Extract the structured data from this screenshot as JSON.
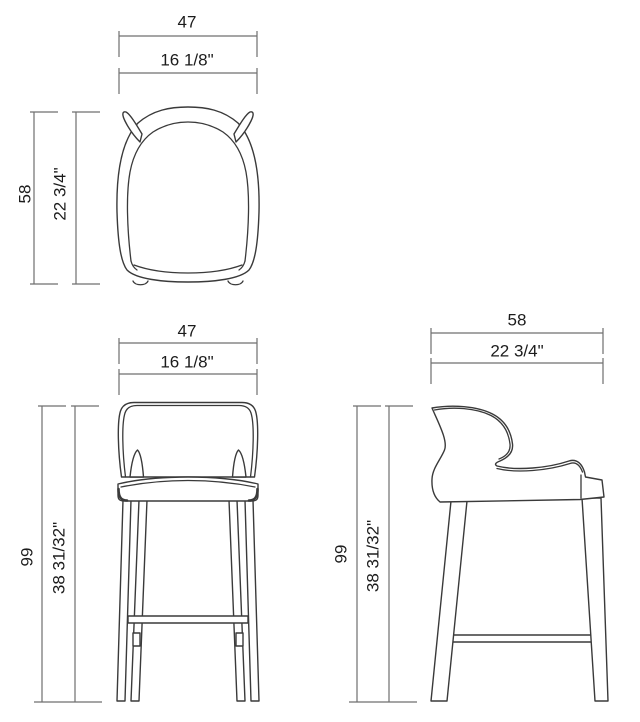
{
  "drawing_title": "bar stool technical dimension drawing",
  "colors": {
    "background": "#ffffff",
    "drawing_line": "#3a3a3a",
    "dimension_line": "#6f6f6f",
    "text": "#1c1c1c"
  },
  "views": {
    "top": {
      "width": {
        "cm": "47",
        "inches": "16 1/8\""
      },
      "depth": {
        "cm": "58",
        "inches": "22 3/4\""
      }
    },
    "front": {
      "width": {
        "cm": "47",
        "inches": "16 1/8\""
      },
      "height": {
        "cm": "99",
        "inches": "38 31/32\""
      }
    },
    "side": {
      "depth": {
        "cm": "58",
        "inches": "22 3/4\""
      },
      "height": {
        "cm": "99",
        "inches": "38 31/32\""
      }
    }
  }
}
